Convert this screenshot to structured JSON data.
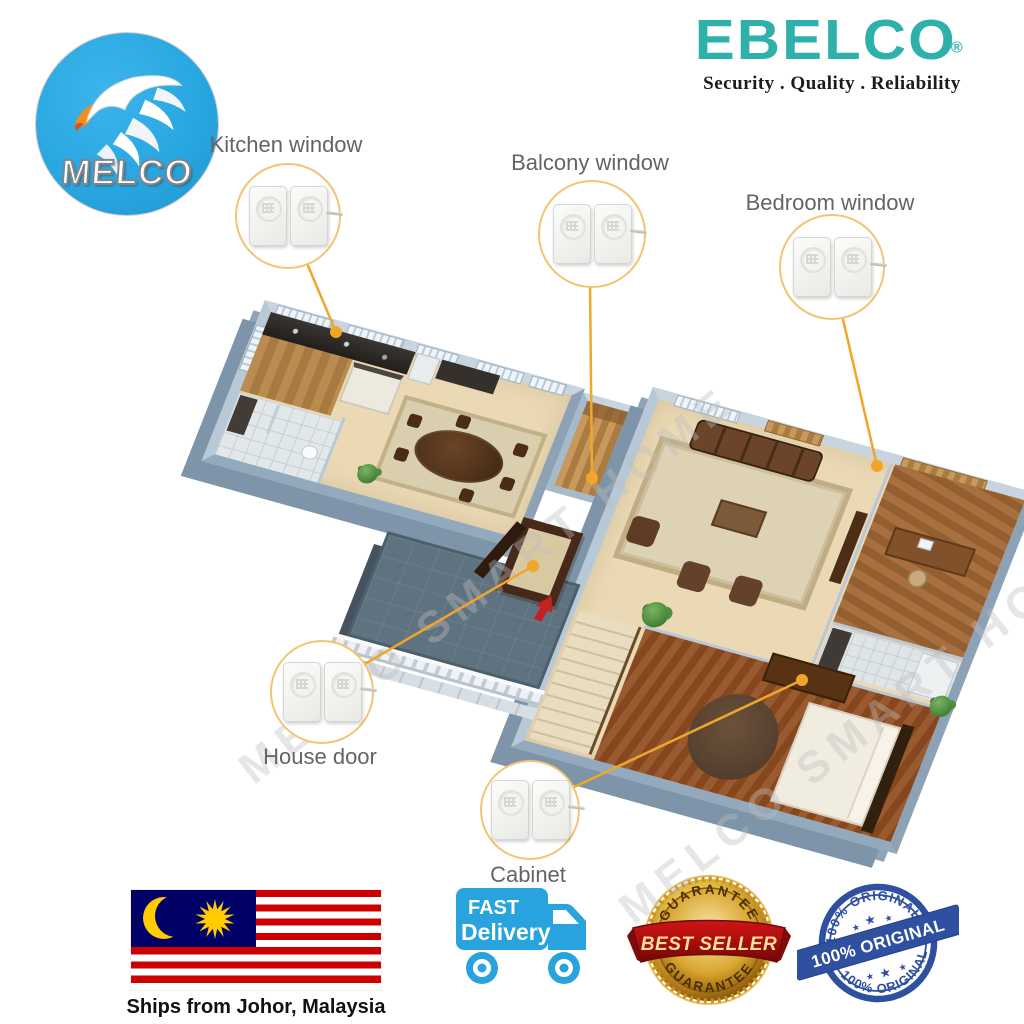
{
  "header": {
    "melco_logo": {
      "text": "MELCO"
    },
    "ebelco_logo": {
      "text": "EBELCO",
      "registered": "®",
      "tagline": "Security . Quality . Reliability"
    }
  },
  "callouts": {
    "kitchen_window": {
      "label": "Kitchen window"
    },
    "balcony_window": {
      "label": "Balcony window"
    },
    "bedroom_window": {
      "label": "Bedroom window"
    },
    "house_door": {
      "label": "House door"
    },
    "cabinet": {
      "label": "Cabinet"
    }
  },
  "watermark": {
    "text": "MELCO SMART HOME"
  },
  "footer": {
    "shipping_caption": "Ships from Johor, Malaysia",
    "fast_delivery": {
      "line1": "FAST",
      "line2": "Delivery"
    },
    "best_seller": {
      "arc_top": "GUARANTEE",
      "ribbon": "BEST SELLER",
      "arc_bottom": "GUARANTEE"
    },
    "original_stamp": {
      "arc_top": "100% ORIGINAL",
      "banner": "100% ORIGINAL",
      "arc_bottom": "100% ORIGINAL"
    }
  },
  "colors": {
    "ebelco_teal": "#2eb1aa",
    "melco_blue": "#2aa7e1",
    "callout_gold": "#efa62a",
    "flag_red": "#cc0001",
    "flag_blue": "#010066",
    "flag_yellow": "#ffcc00",
    "truck_blue": "#29a3dd",
    "stamp_blue": "#24469b",
    "ribbon_red": "#a50d0d",
    "medal_gold": "#d4a017"
  }
}
